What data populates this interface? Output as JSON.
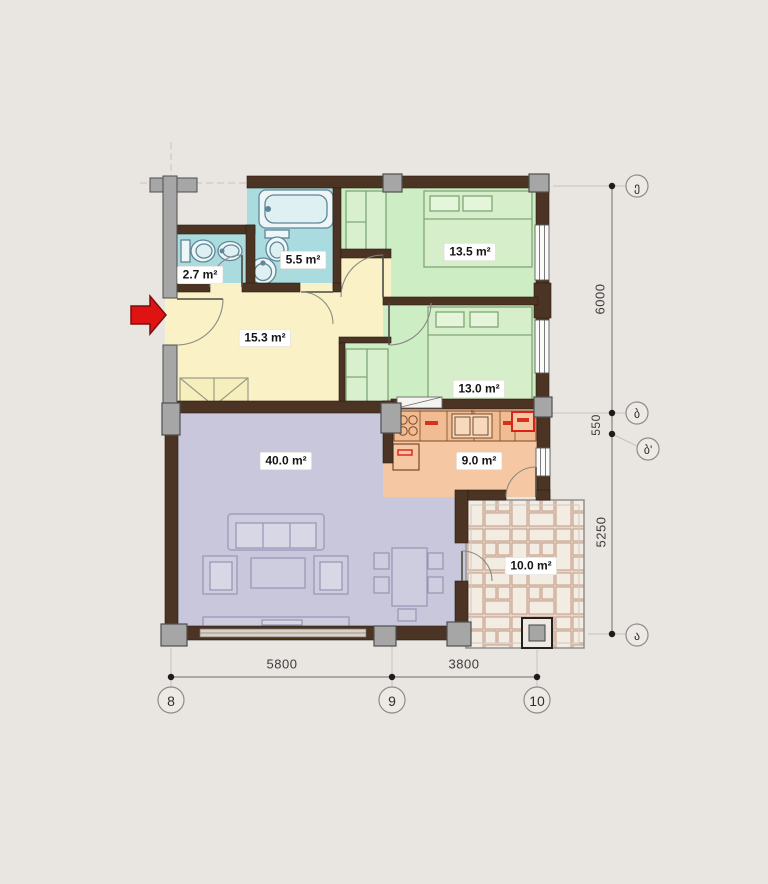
{
  "floor_plan": {
    "rooms": [
      {
        "id": "wc",
        "area_label": "2.7 m²"
      },
      {
        "id": "bathroom",
        "area_label": "5.5 m²"
      },
      {
        "id": "bedroom-top",
        "area_label": "13.5 m²"
      },
      {
        "id": "hallway",
        "area_label": "15.3 m²"
      },
      {
        "id": "bedroom-middle",
        "area_label": "13.0 m²"
      },
      {
        "id": "living-room",
        "area_label": "40.0 m²"
      },
      {
        "id": "kitchen",
        "area_label": "9.0 m²"
      },
      {
        "id": "terrace",
        "area_label": "10.0 m²"
      }
    ],
    "dimensions_right": [
      {
        "label": "6000"
      },
      {
        "label": "550"
      },
      {
        "label": "5250"
      }
    ],
    "dimensions_bottom": [
      {
        "label": "5800"
      },
      {
        "label": "3800"
      }
    ],
    "axis_markers_right": [
      {
        "label": "ე"
      },
      {
        "label": "ბ"
      },
      {
        "label": "ბ'"
      },
      {
        "label": "ა"
      }
    ],
    "axis_markers_bottom": [
      {
        "label": "8"
      },
      {
        "label": "9"
      },
      {
        "label": "10"
      }
    ],
    "colors": {
      "background": "#e9e5e1",
      "walls": "#4b3424",
      "columns": "#a6a6a6",
      "hallway_fill": "#faf2c6",
      "bedroom_fill": "#cdedc5",
      "bathroom_fill": "#aadcdf",
      "living_room_fill": "#c8c7db",
      "kitchen_fill": "#f5c8a3",
      "terrace_joint": "#c49a86",
      "entrance_arrow": "#e01313"
    }
  }
}
